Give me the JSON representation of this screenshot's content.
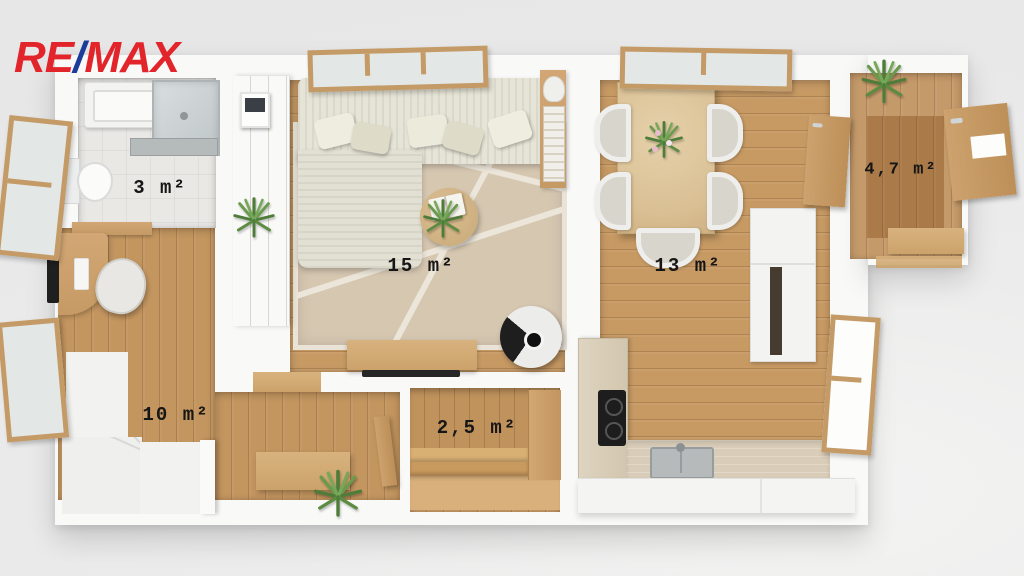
{
  "logo": {
    "part1": "RE",
    "slash": "/",
    "part2": "MAX",
    "color_red": "#e2242b",
    "color_blue": "#1b3c9b"
  },
  "rooms": [
    {
      "id": "bathroom",
      "area_label": "3 m²",
      "area_m2": 3
    },
    {
      "id": "living-room",
      "area_label": "15 m²",
      "area_m2": 15
    },
    {
      "id": "dining-kitchen",
      "area_label": "13 m²",
      "area_m2": 13
    },
    {
      "id": "entry",
      "area_label": "4,7 m²",
      "area_m2": 4.7
    },
    {
      "id": "hall-stairs",
      "area_label": "10 m²",
      "area_m2": 10
    },
    {
      "id": "storage",
      "area_label": "2,5 m²",
      "area_m2": 2.5
    }
  ],
  "palette": {
    "background": "#ececec",
    "wall_white": "#f9f9f8",
    "wood_floor_light": "#c79a64",
    "wood_floor_dark": "#b9854f",
    "wood_furniture": "#cda26e",
    "rug_beige": "#d6c7b1",
    "bathroom_tile": "#e9e8e5",
    "label_text": "#161616"
  }
}
